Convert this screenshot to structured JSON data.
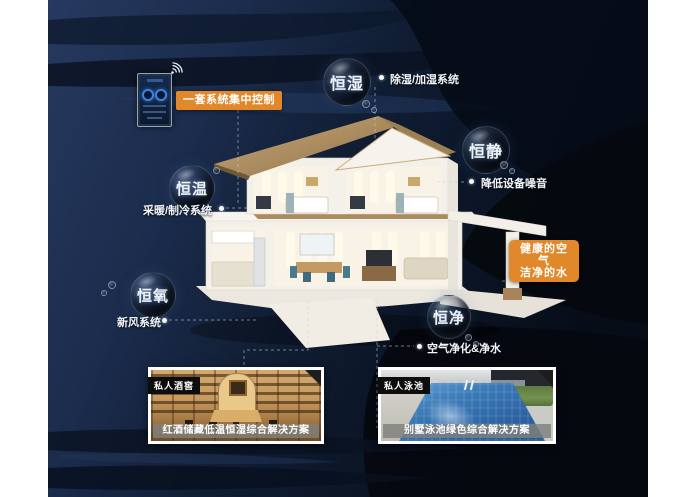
{
  "poster": {
    "bubbles": {
      "hengshi_humidity": "恒湿",
      "hengjing_quiet": "恒静",
      "hengwen_temperature": "恒温",
      "hengyang_oxygen": "恒氧",
      "hengjing_clean": "恒净"
    },
    "labels": {
      "dehumidify_system": "除湿/加湿系统",
      "reduce_noise": "降低设备噪音",
      "heating_cooling_system": "采暖/制冷系统",
      "fresh_air_system": "新风系统",
      "air_water_purification": "空气净化&净水"
    },
    "control_tag": "一套系统集中控制",
    "highlight_box": {
      "line1": "健康的空气",
      "line2": "洁净的水"
    },
    "photos": {
      "wine": {
        "tag": "私人酒窖",
        "caption": "红酒储藏低温恒湿综合解决方案"
      },
      "pool": {
        "tag": "私人泳池",
        "caption": "别墅泳池绿色综合解决方案"
      }
    },
    "icons": {
      "wifi": "wifi-signal",
      "bullet": "bullet-dot"
    },
    "colors": {
      "background_navy": "#1d3054",
      "wave_dark": "#080f1d",
      "accent_orange": "#e1892a",
      "text_white": "#f2f5f9",
      "caption_band_gray": "#807f7b",
      "pool_blue": "#2f6fae",
      "wood_tan": "#c49a62",
      "roof_tan": "#b2905f"
    }
  }
}
